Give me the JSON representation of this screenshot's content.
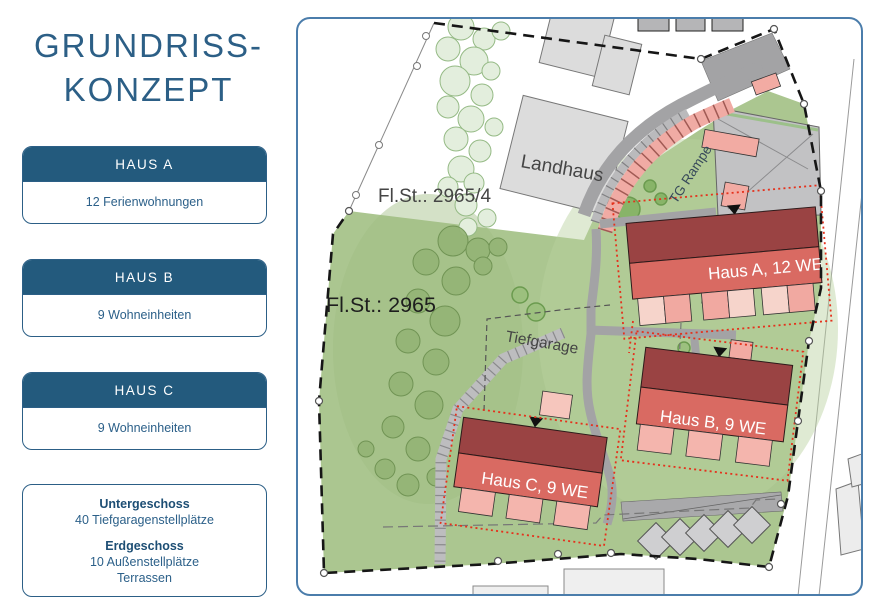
{
  "sidebar": {
    "title_line1": "GRUNDRISS-",
    "title_line2": "KONZEPT",
    "cards": [
      {
        "header": "HAUS A",
        "body": "12 Ferienwohnungen"
      },
      {
        "header": "HAUS B",
        "body": "9 Wohneinheiten"
      },
      {
        "header": "HAUS C",
        "body": "9 Wohneinheiten"
      }
    ],
    "info_card": {
      "section1_title": "Untergeschoss",
      "section1_line": "40 Tiefgaragenstellplätze",
      "section2_title": "Erdgeschoss",
      "section2_line1": "10 Außenstellplätze",
      "section2_line2": "Terrassen"
    }
  },
  "map": {
    "labels": {
      "parcel_small": "Fl.St.: 2965/4",
      "parcel_large": "Fl.St.: 2965",
      "landhaus": "Landhaus",
      "tiefgarage": "Tiefgarage",
      "tg_rampe": "TG Rampe",
      "haus_a": "Haus A, 12 WE",
      "haus_b": "Haus B, 9 WE",
      "haus_c": "Haus C, 9 WE"
    },
    "colors": {
      "accent_blue": "#2c5f86",
      "card_header_blue": "#235a7d",
      "map_border_blue": "#4b7dab",
      "grass_green": "#abc690",
      "tree_dark_green": "#94b475",
      "tree_light_green": "#e3eedd",
      "building_roof_dark": "#9a4343",
      "building_roof_light": "#d96a62",
      "terrace_pink": "#f1a9a1",
      "terrace_light": "#f6d4cb",
      "ramp_pink": "#f0aba4",
      "road_gray": "#a3a3a5",
      "neighbor_gray": "#dcdcdc",
      "tg_outline_red": "#e5311c",
      "boundary_black": "#161616"
    }
  }
}
